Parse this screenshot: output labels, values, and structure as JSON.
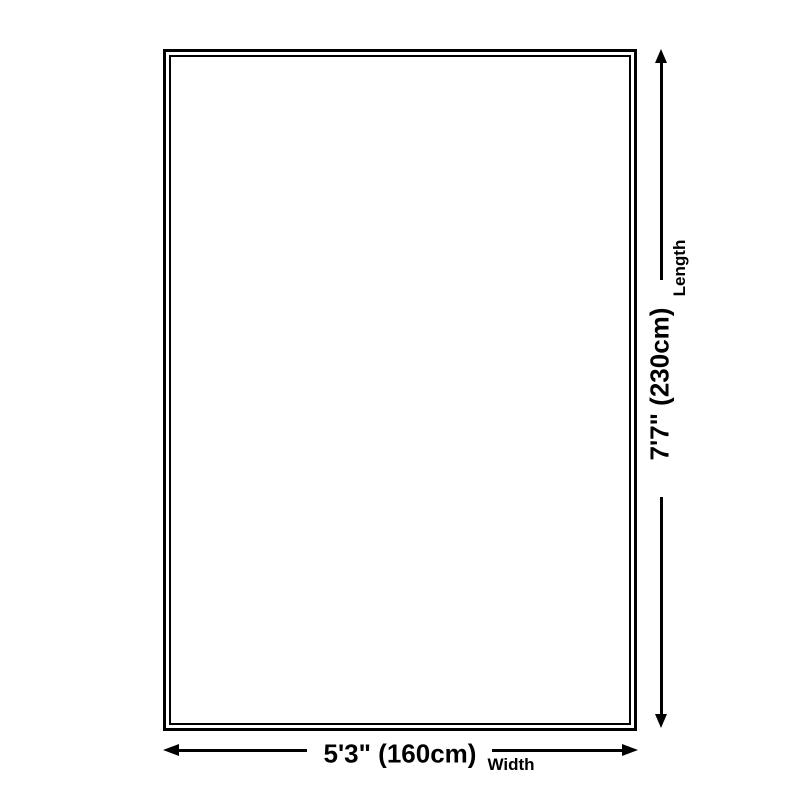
{
  "diagram": {
    "type": "product-dimension-diagram",
    "colors": {
      "line": "#000000",
      "background": "#ffffff"
    },
    "width": {
      "value": "5'3\" (160cm)",
      "caption": "Width"
    },
    "length": {
      "value": "7'7\" (230cm)",
      "caption": "Length"
    }
  }
}
